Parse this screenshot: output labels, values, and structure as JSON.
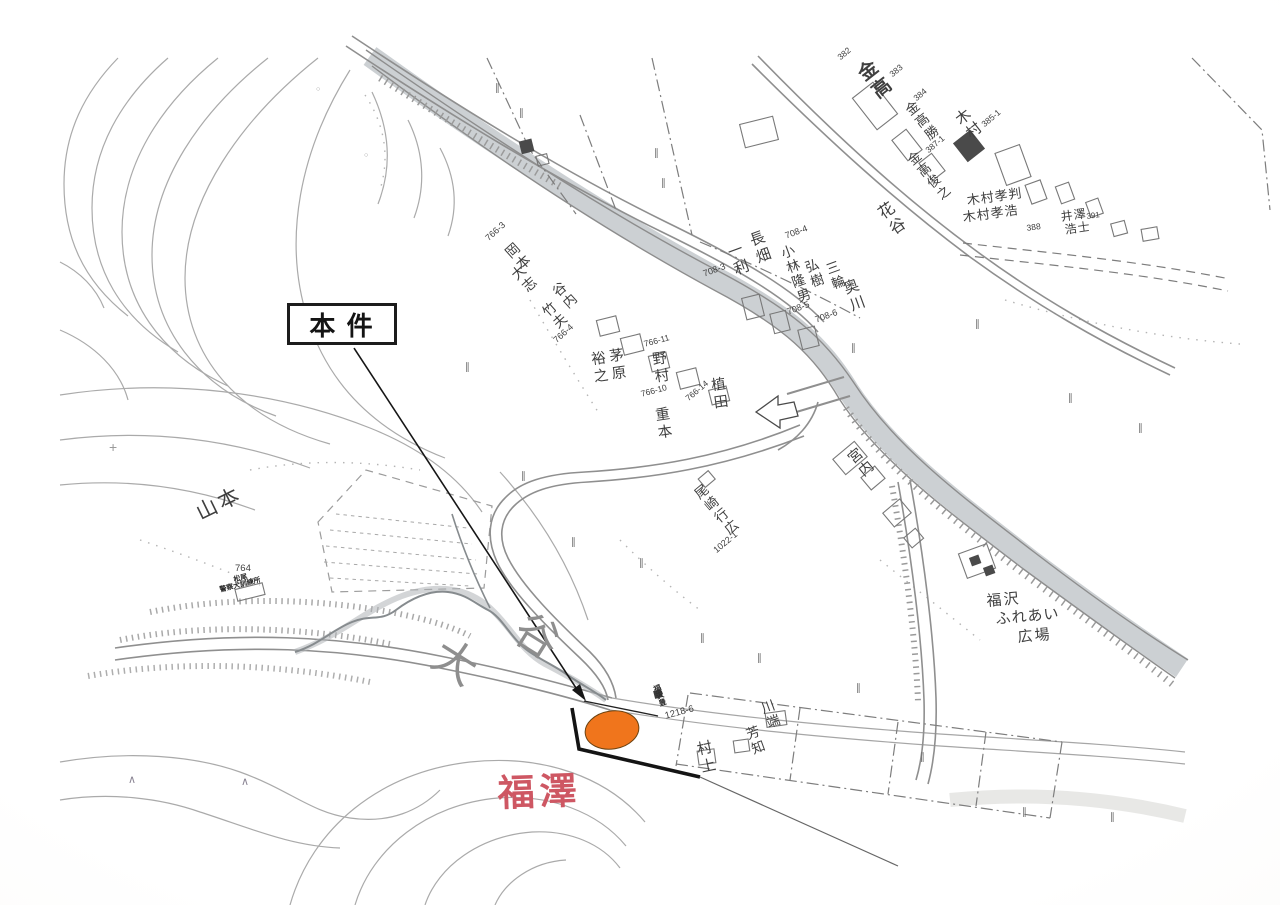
{
  "annotation": {
    "label": "本 件"
  },
  "site_marker": {
    "color": "#F0751C",
    "outline": "#6B4210"
  },
  "map": {
    "labels": [
      {
        "n": "valley-name-char",
        "t": "大",
        "x": 448,
        "y": 632,
        "s": 44,
        "r": 32,
        "c": "#8e8e8e"
      },
      {
        "n": "valley-name-char",
        "t": "谷",
        "x": 530,
        "y": 606,
        "s": 44,
        "r": 32,
        "c": "#8e8e8e"
      },
      {
        "n": "place-name-yamamoto",
        "t": "山本",
        "x": 193,
        "y": 505,
        "s": 21,
        "r": -26,
        "ls": 3
      },
      {
        "n": "red-place-label-fukuzawa",
        "t": "福澤",
        "x": 497,
        "y": 775,
        "s": 37,
        "r": -2,
        "c": "#ce5763",
        "w": 700,
        "ls": 5
      },
      {
        "n": "facility-name-plaza",
        "t": "福沢",
        "x": 986,
        "y": 594,
        "s": 15,
        "r": -5,
        "ls": 2
      },
      {
        "n": "facility-name-plaza",
        "t": "ふれあい",
        "x": 995,
        "y": 612,
        "s": 15,
        "r": -5,
        "ls": 1
      },
      {
        "n": "facility-name-plaza",
        "t": "広場",
        "x": 1017,
        "y": 630,
        "s": 15,
        "r": -5,
        "ls": 2
      },
      {
        "n": "owner-name",
        "t": "金高",
        "x": 852,
        "y": 70,
        "s": 19,
        "r": -38,
        "v": 1,
        "ls": 3,
        "w": 600
      },
      {
        "n": "parcel-number",
        "t": "382",
        "x": 836,
        "y": 55,
        "s": 8.5,
        "r": -40
      },
      {
        "n": "parcel-number",
        "t": "383",
        "x": 888,
        "y": 72,
        "s": 8.5,
        "r": -40
      },
      {
        "n": "owner-name",
        "t": "金高勝",
        "x": 901,
        "y": 108,
        "s": 13.5,
        "r": -38,
        "v": 1,
        "ls": 2
      },
      {
        "n": "parcel-number",
        "t": "384",
        "x": 912,
        "y": 96,
        "s": 8.5,
        "r": -40
      },
      {
        "n": "owner-name",
        "t": "木村",
        "x": 951,
        "y": 116,
        "s": 15,
        "r": -38,
        "v": 1,
        "ls": 2
      },
      {
        "n": "parcel-number",
        "t": "385-1",
        "x": 980,
        "y": 122,
        "s": 8.5,
        "r": -40
      },
      {
        "n": "owner-name",
        "t": "金高俊之",
        "x": 904,
        "y": 158,
        "s": 13,
        "r": -40,
        "v": 1,
        "ls": 2
      },
      {
        "n": "parcel-number",
        "t": "387-1",
        "x": 924,
        "y": 148,
        "s": 8.5,
        "r": -40
      },
      {
        "n": "owner-name",
        "t": "木村孝判",
        "x": 966,
        "y": 194,
        "s": 13,
        "r": -8,
        "ls": 1
      },
      {
        "n": "owner-name",
        "t": "木村孝浩",
        "x": 962,
        "y": 211,
        "s": 13,
        "r": -8,
        "ls": 1
      },
      {
        "n": "parcel-number",
        "t": "388",
        "x": 1026,
        "y": 224,
        "s": 8.5,
        "r": -8
      },
      {
        "n": "owner-name",
        "t": "井澤",
        "x": 1060,
        "y": 211,
        "s": 12,
        "r": -8,
        "ls": 1
      },
      {
        "n": "parcel-number",
        "t": "391",
        "x": 1086,
        "y": 213,
        "s": 8,
        "r": -8
      },
      {
        "n": "owner-name",
        "t": "浩士",
        "x": 1064,
        "y": 224,
        "s": 12,
        "r": -8,
        "ls": 1
      },
      {
        "n": "owner-name",
        "t": "花谷",
        "x": 872,
        "y": 210,
        "s": 16,
        "r": -35,
        "v": 1,
        "ls": 3
      },
      {
        "n": "owner-name",
        "t": "長畑",
        "x": 746,
        "y": 234,
        "s": 15,
        "r": -20,
        "v": 1,
        "ls": 3
      },
      {
        "n": "owner-name",
        "t": "一利",
        "x": 724,
        "y": 246,
        "s": 15,
        "r": -20,
        "v": 1,
        "ls": 3
      },
      {
        "n": "parcel-number",
        "t": "708-3",
        "x": 702,
        "y": 270,
        "s": 9,
        "r": -20
      },
      {
        "n": "owner-name",
        "t": "小林隆男",
        "x": 777,
        "y": 248,
        "s": 13.5,
        "r": -20,
        "v": 1,
        "ls": 2
      },
      {
        "n": "parcel-number",
        "t": "708-4",
        "x": 784,
        "y": 232,
        "s": 9,
        "r": -20
      },
      {
        "n": "owner-name",
        "t": "弘樹",
        "x": 801,
        "y": 262,
        "s": 13.5,
        "r": -20,
        "v": 1,
        "ls": 2
      },
      {
        "n": "owner-name",
        "t": "三輪",
        "x": 822,
        "y": 264,
        "s": 13.5,
        "r": -20,
        "v": 1,
        "ls": 2
      },
      {
        "n": "parcel-number",
        "t": "708-5",
        "x": 786,
        "y": 308,
        "s": 9,
        "r": -20
      },
      {
        "n": "parcel-number",
        "t": "708-6",
        "x": 814,
        "y": 316,
        "s": 9,
        "r": -20
      },
      {
        "n": "owner-name",
        "t": "奥川",
        "x": 840,
        "y": 282,
        "s": 15,
        "r": -20,
        "v": 1,
        "ls": 3
      },
      {
        "n": "parcel-number",
        "t": "766-3",
        "x": 484,
        "y": 236,
        "s": 9,
        "r": -42
      },
      {
        "n": "owner-name",
        "t": "岡本",
        "x": 502,
        "y": 250,
        "s": 14,
        "r": -42,
        "v": 1,
        "ls": 2
      },
      {
        "n": "owner-name",
        "t": "大志",
        "x": 508,
        "y": 272,
        "s": 14,
        "r": -42,
        "v": 1,
        "ls": 2
      },
      {
        "n": "owner-name",
        "t": "谷内",
        "x": 548,
        "y": 290,
        "s": 13.5,
        "r": -42,
        "v": 1,
        "ls": 2
      },
      {
        "n": "owner-name",
        "t": "竹夫",
        "x": 538,
        "y": 310,
        "s": 13.5,
        "r": -42,
        "v": 1,
        "ls": 2
      },
      {
        "n": "parcel-number",
        "t": "766-4",
        "x": 552,
        "y": 338,
        "s": 9,
        "r": -42
      },
      {
        "n": "owner-name",
        "t": "茅原",
        "x": 606,
        "y": 349,
        "s": 14.5,
        "r": -8,
        "v": 1,
        "ls": 3
      },
      {
        "n": "owner-name",
        "t": "裕之",
        "x": 588,
        "y": 352,
        "s": 14.5,
        "r": -8,
        "v": 1,
        "ls": 3
      },
      {
        "n": "owner-name",
        "t": "野村",
        "x": 649,
        "y": 352,
        "s": 14.5,
        "r": -8,
        "v": 1,
        "ls": 3
      },
      {
        "n": "parcel-number",
        "t": "766-11",
        "x": 643,
        "y": 340,
        "s": 8.5,
        "r": -15
      },
      {
        "n": "parcel-number",
        "t": "766-10",
        "x": 640,
        "y": 390,
        "s": 8.5,
        "r": -15
      },
      {
        "n": "owner-name",
        "t": "重本",
        "x": 652,
        "y": 408,
        "s": 14.5,
        "r": -8,
        "v": 1,
        "ls": 3
      },
      {
        "n": "owner-name",
        "t": "植田",
        "x": 708,
        "y": 378,
        "s": 14.5,
        "r": -8,
        "v": 1,
        "ls": 3
      },
      {
        "n": "parcel-number",
        "t": "766-14",
        "x": 684,
        "y": 396,
        "s": 8.5,
        "r": -40
      },
      {
        "n": "owner-name",
        "t": "尾崎行広",
        "x": 690,
        "y": 492,
        "s": 13.5,
        "r": -40,
        "v": 1,
        "ls": 2
      },
      {
        "n": "parcel-number",
        "t": "1022-1",
        "x": 712,
        "y": 548,
        "s": 9,
        "r": -40
      },
      {
        "n": "owner-name",
        "t": "宮内",
        "x": 843,
        "y": 456,
        "s": 14.5,
        "r": -40,
        "v": 1,
        "ls": 2
      },
      {
        "n": "owner-name",
        "t": "川端",
        "x": 757,
        "y": 703,
        "s": 13.5,
        "r": -20,
        "v": 1,
        "ls": 2
      },
      {
        "n": "owner-name",
        "t": "芳知",
        "x": 742,
        "y": 729,
        "s": 13.5,
        "r": -20,
        "v": 1,
        "ls": 2
      },
      {
        "n": "owner-name",
        "t": "村上",
        "x": 694,
        "y": 742,
        "s": 15,
        "r": -12,
        "v": 1,
        "ls": 3
      },
      {
        "n": "parcel-number",
        "t": "1218-6",
        "x": 664,
        "y": 712,
        "s": 9.5,
        "r": -15
      },
      {
        "n": "owner-name",
        "t": "福沢豊",
        "x": 652,
        "y": 686,
        "s": 7.5,
        "r": -20,
        "v": 1,
        "w": 700,
        "c": "#2e2e2e"
      },
      {
        "n": "spot-elevation",
        "t": "764",
        "x": 235,
        "y": 564,
        "s": 9.5
      },
      {
        "n": "facility-name-kennel",
        "t": "松尾",
        "x": 233,
        "y": 577,
        "s": 7,
        "r": -14,
        "w": 700,
        "c": "#2c2c2c"
      },
      {
        "n": "facility-name-kennel",
        "t": "警察犬訓練所",
        "x": 219,
        "y": 587,
        "s": 7,
        "r": -14,
        "w": 700,
        "c": "#2c2c2c"
      },
      {
        "n": "vegetation-symbol",
        "t": "∥",
        "x": 495,
        "y": 84,
        "s": 10,
        "c": "#6e6e6e"
      },
      {
        "n": "vegetation-symbol",
        "t": "∥",
        "x": 519,
        "y": 109,
        "s": 10,
        "c": "#6e6e6e"
      },
      {
        "n": "vegetation-symbol",
        "t": "∥",
        "x": 654,
        "y": 149,
        "s": 10,
        "c": "#6e6e6e"
      },
      {
        "n": "vegetation-symbol",
        "t": "∥",
        "x": 661,
        "y": 179,
        "s": 10,
        "c": "#6e6e6e"
      },
      {
        "n": "vegetation-symbol",
        "t": "∥",
        "x": 465,
        "y": 363,
        "s": 10,
        "c": "#6e6e6e"
      },
      {
        "n": "vegetation-symbol",
        "t": "∥",
        "x": 521,
        "y": 472,
        "s": 10,
        "c": "#6e6e6e"
      },
      {
        "n": "vegetation-symbol",
        "t": "∥",
        "x": 571,
        "y": 538,
        "s": 10,
        "c": "#6e6e6e"
      },
      {
        "n": "vegetation-symbol",
        "t": "∥",
        "x": 639,
        "y": 559,
        "s": 10,
        "c": "#6e6e6e"
      },
      {
        "n": "vegetation-symbol",
        "t": "∥",
        "x": 700,
        "y": 634,
        "s": 10,
        "c": "#6e6e6e"
      },
      {
        "n": "vegetation-symbol",
        "t": "∥",
        "x": 757,
        "y": 654,
        "s": 10,
        "c": "#6e6e6e"
      },
      {
        "n": "vegetation-symbol",
        "t": "∥",
        "x": 856,
        "y": 684,
        "s": 10,
        "c": "#6e6e6e"
      },
      {
        "n": "vegetation-symbol",
        "t": "∥",
        "x": 920,
        "y": 753,
        "s": 10,
        "c": "#6e6e6e"
      },
      {
        "n": "vegetation-symbol",
        "t": "∥",
        "x": 1022,
        "y": 808,
        "s": 10,
        "c": "#6e6e6e"
      },
      {
        "n": "vegetation-symbol",
        "t": "∥",
        "x": 1110,
        "y": 813,
        "s": 10,
        "c": "#6e6e6e"
      },
      {
        "n": "vegetation-symbol",
        "t": "∥",
        "x": 975,
        "y": 320,
        "s": 10,
        "c": "#6e6e6e"
      },
      {
        "n": "vegetation-symbol",
        "t": "∥",
        "x": 1068,
        "y": 394,
        "s": 10,
        "c": "#6e6e6e"
      },
      {
        "n": "vegetation-symbol",
        "t": "∥",
        "x": 1138,
        "y": 424,
        "s": 10,
        "c": "#6e6e6e"
      },
      {
        "n": "vegetation-symbol",
        "t": "∥",
        "x": 851,
        "y": 344,
        "s": 10,
        "c": "#6e6e6e"
      },
      {
        "n": "triangle-symbol",
        "t": "∧",
        "x": 128,
        "y": 775,
        "s": 11,
        "c": "#8b8594"
      },
      {
        "n": "triangle-symbol",
        "t": "∧",
        "x": 241,
        "y": 777,
        "s": 11,
        "c": "#8b8594"
      },
      {
        "n": "cross-symbol",
        "t": "+",
        "x": 109,
        "y": 440,
        "s": 14,
        "c": "#9a9a9a"
      },
      {
        "n": "circle-symbol",
        "t": "○",
        "x": 316,
        "y": 86,
        "s": 7,
        "c": "#9a9a9a"
      },
      {
        "n": "circle-symbol",
        "t": "○",
        "x": 364,
        "y": 152,
        "s": 7,
        "c": "#9a9a9a"
      }
    ]
  }
}
